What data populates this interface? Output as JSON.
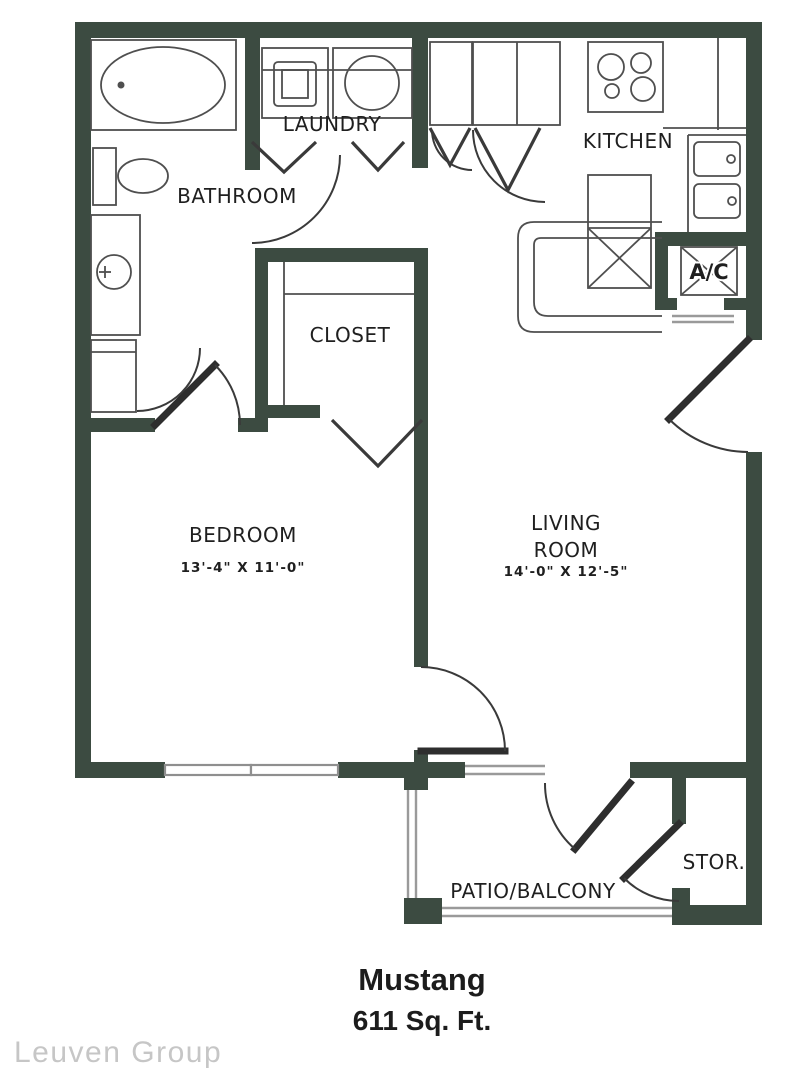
{
  "floorplan": {
    "title": "Mustang",
    "area": "611 Sq. Ft.",
    "watermark": "Leuven Group",
    "rooms": {
      "laundry": {
        "label": "LAUNDRY"
      },
      "kitchen": {
        "label": "KITCHEN"
      },
      "bathroom": {
        "label": "BATHROOM"
      },
      "closet": {
        "label": "CLOSET"
      },
      "bedroom": {
        "label": "BEDROOM",
        "dimensions": "13'-4\" X 11'-0\""
      },
      "living_room": {
        "label_line1": "LIVING",
        "label_line2": "ROOM",
        "dimensions": "14'-0\" X 12'-5\""
      },
      "patio": {
        "label": "PATIO/BALCONY"
      },
      "storage": {
        "label": "STOR."
      },
      "ac_closet": {
        "label": "A/C"
      }
    },
    "colors": {
      "wall": "#3c4b41",
      "fixture_line": "#4f4f4f",
      "text": "#1f1f1f",
      "watermark": "#c6c6c6"
    }
  }
}
